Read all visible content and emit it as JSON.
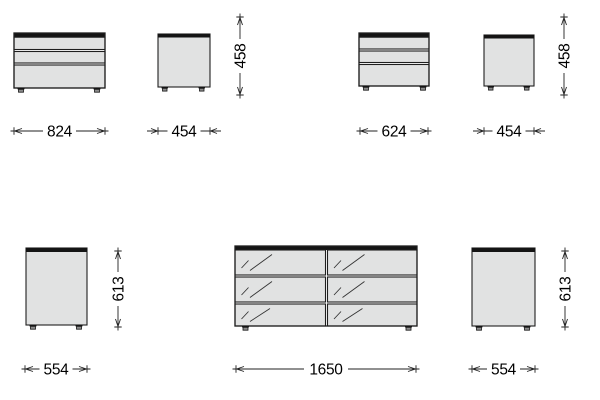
{
  "drawing": {
    "type": "furniture dimension drawing",
    "background": "#ffffff"
  },
  "colors": {
    "panel_fill": "#e1e2e2",
    "panel_stroke": "#1f1f1f",
    "top_panel": "#141414",
    "dimension_line": "#222222",
    "dimension_text": "#000000"
  },
  "pieces": [
    {
      "id": "chest-824",
      "view": "front",
      "drawers": 3,
      "width": "824"
    },
    {
      "id": "pedestal-454-left",
      "view": "side",
      "width": "454",
      "height": "458"
    },
    {
      "id": "chest-624",
      "view": "front",
      "drawers": 3,
      "width": "624"
    },
    {
      "id": "pedestal-454-right",
      "view": "side",
      "width": "454",
      "height": "458"
    },
    {
      "id": "cabinet-554-left",
      "view": "side",
      "width": "554",
      "height": "613"
    },
    {
      "id": "dresser-1650",
      "view": "front",
      "drawers": 6,
      "drawer_front": "glass",
      "width": "1650"
    },
    {
      "id": "cabinet-554-right",
      "view": "side",
      "width": "554",
      "height": "613"
    }
  ],
  "dimensions": {
    "w824": "824",
    "w454_left": "454",
    "h458_left": "458",
    "w624": "624",
    "w454_right": "454",
    "h458_right": "458",
    "w554_left": "554",
    "h613_left": "613",
    "w1650": "1650",
    "w554_right": "554",
    "h613_right": "613"
  }
}
